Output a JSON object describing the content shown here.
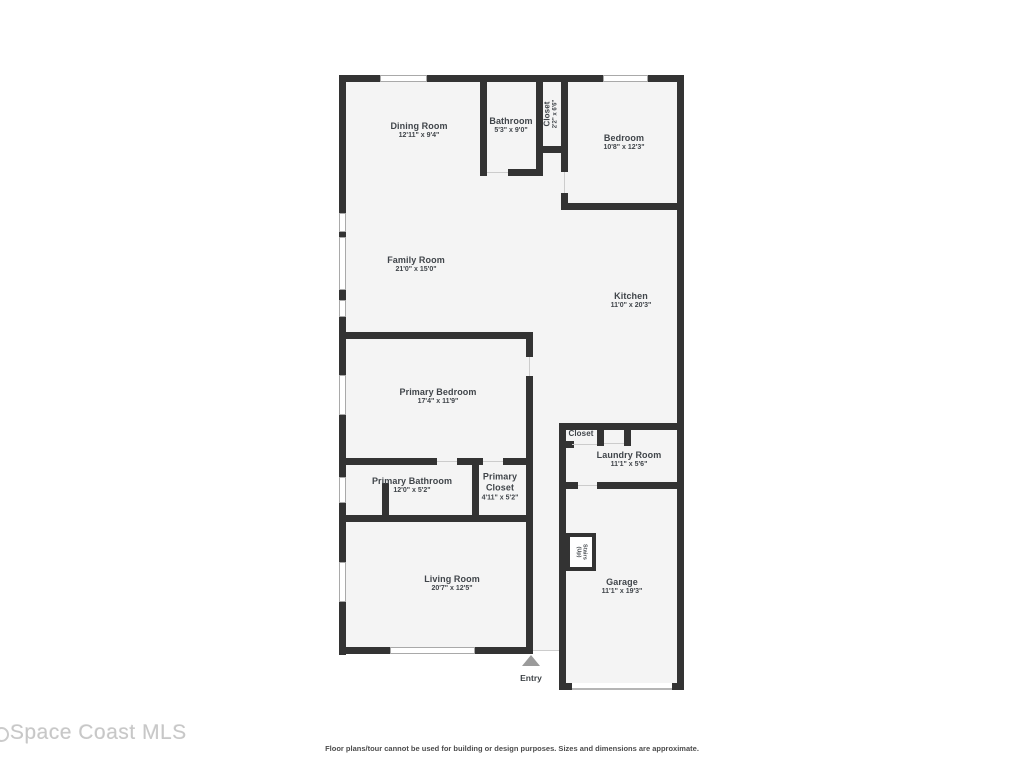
{
  "watermark": {
    "text": "Space Coast MLS"
  },
  "disclaimer": "Floor plans/tour cannot be used for building or design purposes. Sizes and dimensions are approximate.",
  "colors": {
    "wall": "#333333",
    "floor": "#f4f4f4",
    "label_text": "#40454a",
    "watermark_text": "#c7c7c7",
    "entry_arrow": "#9b9b9b"
  },
  "rooms": {
    "dining_room": {
      "name": "Dining Room",
      "dims": "12'11\" x 9'4\""
    },
    "bathroom": {
      "name": "Bathroom",
      "dims": "5'3\" x 9'0\""
    },
    "hall_closet": {
      "name": "Closet",
      "dims": "2'2\" x 6'6\""
    },
    "bedroom": {
      "name": "Bedroom",
      "dims": "10'8\" x 12'3\""
    },
    "family_room": {
      "name": "Family Room",
      "dims": "21'0\" x 15'0\""
    },
    "kitchen": {
      "name": "Kitchen",
      "dims": "11'0\" x 20'3\""
    },
    "primary_bedroom": {
      "name": "Primary Bedroom",
      "dims": "17'4\" x 11'9\""
    },
    "laundry_closet": {
      "name": "Closet"
    },
    "laundry_room": {
      "name": "Laundry Room",
      "dims": "11'1\" x 5'6\""
    },
    "primary_bathroom": {
      "name": "Primary Bathroom",
      "dims": "12'0\" x 5'2\""
    },
    "primary_closet": {
      "name": "Primary Closet",
      "dims": "4'11\" x 5'2\""
    },
    "living_room": {
      "name": "Living Room",
      "dims": "20'7\" x 12'5\""
    },
    "stairs": {
      "name": "Stairs",
      "sub": "(Up)"
    },
    "garage": {
      "name": "Garage",
      "dims": "11'1\" x 19'3\""
    },
    "entry": {
      "name": "Entry"
    }
  }
}
